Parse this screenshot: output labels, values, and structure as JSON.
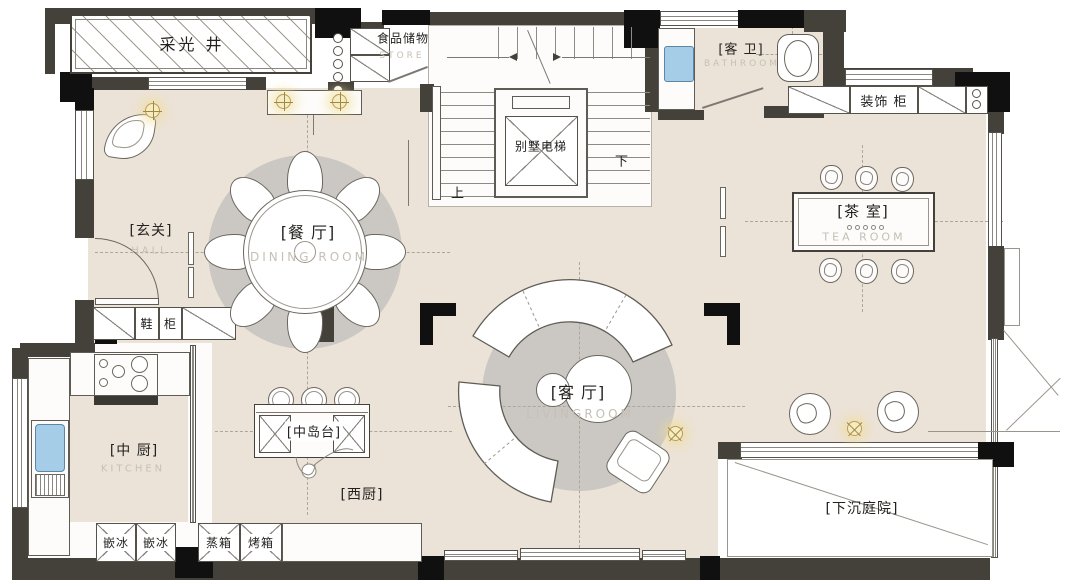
{
  "colors": {
    "floor": "#ece3d8",
    "wall": "#44413b",
    "column": "#101010",
    "rug": "#cbc8c3",
    "water_blue": "#a5cde8",
    "lamp_glow": "#f0dfa4"
  },
  "rooms": {
    "light_well": {
      "name": "采光 井"
    },
    "store": {
      "name": "食品储物",
      "en": "STORE"
    },
    "elevator": {
      "name": "别墅电梯"
    },
    "stairs": {
      "up": "上",
      "down": "下"
    },
    "bathroom": {
      "name": "[客 卫]",
      "en": "BATHROOM"
    },
    "deco_cabinet": {
      "name": "装饰 柜"
    },
    "hall": {
      "name": "[玄关]",
      "en": "HALL"
    },
    "shoe_cabinet": {
      "a": "鞋",
      "b": "柜"
    },
    "dining": {
      "name": "[餐 厅]",
      "en": "DINING ROOM"
    },
    "tea_room": {
      "name": "[茶 室]",
      "en": "TEA ROOM"
    },
    "living": {
      "name": "[客 厅]",
      "en": "LIVINGROOM"
    },
    "kitchen": {
      "name": "[中 厨]",
      "en": "KITCHEN"
    },
    "island": {
      "name": "[中岛台]"
    },
    "west_kitchen": {
      "name": "[西厨]"
    },
    "courtyard": {
      "name": "[下沉庭院]"
    },
    "appliances": [
      "嵌冰",
      "嵌冰",
      "蒸箱",
      "烤箱"
    ]
  }
}
